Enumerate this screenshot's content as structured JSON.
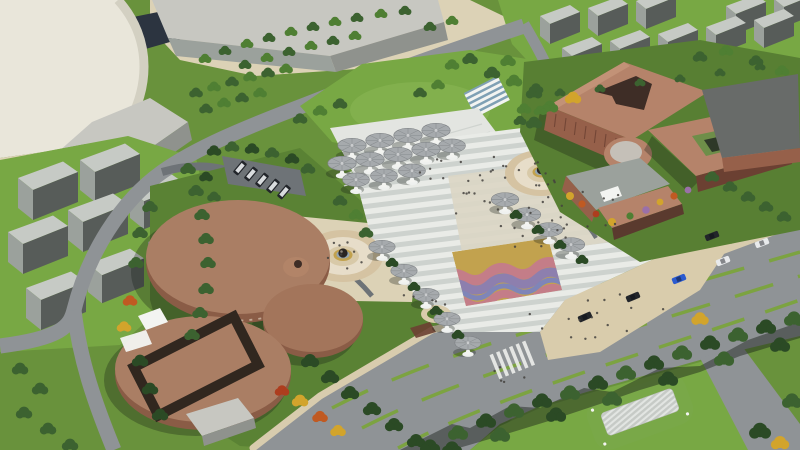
{
  "meta": {
    "title": "Aerial 3D rendering — cultural centre plaza and campus",
    "view": "bird's-eye oblique",
    "visible_text": "none"
  },
  "palette": {
    "base": "#69923C",
    "grassDark": "#4F7A2E",
    "lawn": "#78A844",
    "lawnLight": "#8AB755",
    "gardenOlive": "#5A8234",
    "treeDark": "#2B4A25",
    "treeMid": "#3C6230",
    "treeGreen": "#4F7F33",
    "treeLight": "#6FA047",
    "treeYellow": "#D2A42C",
    "treeOrange": "#C05A22",
    "treeRed": "#AD3D1E",
    "treePurple": "#9A70A8",
    "road": "#8F9396",
    "roadDark": "#73777A",
    "asphalt": "#6E7377",
    "median": "#7CA341",
    "sidewalk": "#D8CCAE",
    "plazaLight": "#E9EBE7",
    "plazaStripe": "#CDD2CE",
    "plazaCenter": "#DBD6C6",
    "terrace": "#E3E5E1",
    "esplanade": "#D9CCAC",
    "circleOuter": "#D5C3A2",
    "circleMid": "#E7DDC9",
    "circleIn": "#D8C9A8",
    "goldRing": "#C2A24E",
    "waterRing": "#95A6B2",
    "sphere": "#2A2521",
    "canopy": "#A6AAAD",
    "canopyEdge": "#7D8184",
    "canopyBase": "#EFF1EF",
    "drumTop": "#AA7E64",
    "drumSide": "#8A5C46",
    "drumDark": "#6B4334",
    "frameDark": "#31271F",
    "terraRoof": "#B5836A",
    "terraWall": "#96604A",
    "terraDark": "#6B4032",
    "courtDark": "#3E2D26",
    "greenRoof": "#6E8E49",
    "greenRoofDark": "#2E3828",
    "towerTop": "#C6CAC5",
    "towerFace": "#9BA19C",
    "towerSide": "#575C59",
    "cream": "#E9E6DA",
    "creamSide": "#D3D0C2",
    "concrete": "#C7C7C1",
    "concreteDark": "#8F928D",
    "navyShadow": "#2C3440",
    "beige": "#DCD2B6",
    "white": "#F3F4F1",
    "carWhite": "#E8EAEC",
    "carBlue": "#2A5AD0",
    "carDark": "#22252A",
    "person": "#44423E",
    "shadow": "rgba(20,26,20,0.30)",
    "treeShadow": "rgba(24,32,24,0.45)",
    "wavyRose": "#C47D88",
    "wavyPurple": "#8D7FAE",
    "wavyBlue": "#7F85B8"
  },
  "scene": {
    "landmarks": [
      "cream-cylinder-tower",
      "industrial-slabs",
      "north-residential-towers",
      "west-residential-slabs",
      "striped-central-plaza",
      "mushroom-canopy-cluster",
      "west-canopy-row",
      "east-canopy-row",
      "sphere-fountain-circle-west",
      "sphere-fountain-circle-east",
      "wavy-art-pavement",
      "cultural-center-drum-buildings",
      "east-terracotta-complex",
      "rooftop-garden",
      "boulevard",
      "south-tree-belt",
      "louvered-pavilion",
      "parking-lot",
      "bus-layby-island"
    ],
    "counts": {
      "canopy_cluster": 12,
      "canopy_row_west": 5,
      "canopy_row_east": 4,
      "drum_volumes": 4,
      "road_cars": 6,
      "parked_vans": 5
    },
    "people": {
      "dot_radius": 1.2,
      "regions": [
        {
          "cx": 540,
          "cy": 205,
          "rx": 88,
          "ry": 44,
          "n": 40,
          "seed": 7
        },
        {
          "cx": 470,
          "cy": 170,
          "rx": 55,
          "ry": 22,
          "n": 10,
          "seed": 11
        },
        {
          "cx": 600,
          "cy": 318,
          "rx": 78,
          "ry": 26,
          "n": 16,
          "seed": 3
        },
        {
          "cx": 343,
          "cy": 256,
          "rx": 28,
          "ry": 16,
          "n": 8,
          "seed": 5
        },
        {
          "cx": 541,
          "cy": 173,
          "rx": 24,
          "ry": 13,
          "n": 7,
          "seed": 9
        },
        {
          "cx": 430,
          "cy": 300,
          "rx": 30,
          "ry": 14,
          "n": 5,
          "seed": 13
        },
        {
          "cx": 505,
          "cy": 372,
          "rx": 26,
          "ry": 12,
          "n": 5,
          "seed": 17
        }
      ]
    },
    "vehicles": {
      "cars": [
        {
          "x": 762,
          "y": 243,
          "a": -21,
          "c": "carWhite"
        },
        {
          "x": 723,
          "y": 261,
          "a": -22,
          "c": "carWhite"
        },
        {
          "x": 679,
          "y": 279,
          "a": -22,
          "c": "carBlue"
        },
        {
          "x": 633,
          "y": 297,
          "a": -23,
          "c": "carDark"
        },
        {
          "x": 585,
          "y": 317,
          "a": -24,
          "c": "carDark"
        },
        {
          "x": 712,
          "y": 236,
          "a": -21,
          "c": "carDark"
        }
      ],
      "vans": [
        {
          "x": 240,
          "y": 168,
          "a": -50
        },
        {
          "x": 251,
          "y": 174,
          "a": -50
        },
        {
          "x": 262,
          "y": 180,
          "a": -50
        },
        {
          "x": 273,
          "y": 186,
          "a": -50
        },
        {
          "x": 284,
          "y": 192,
          "a": -50
        }
      ]
    }
  }
}
